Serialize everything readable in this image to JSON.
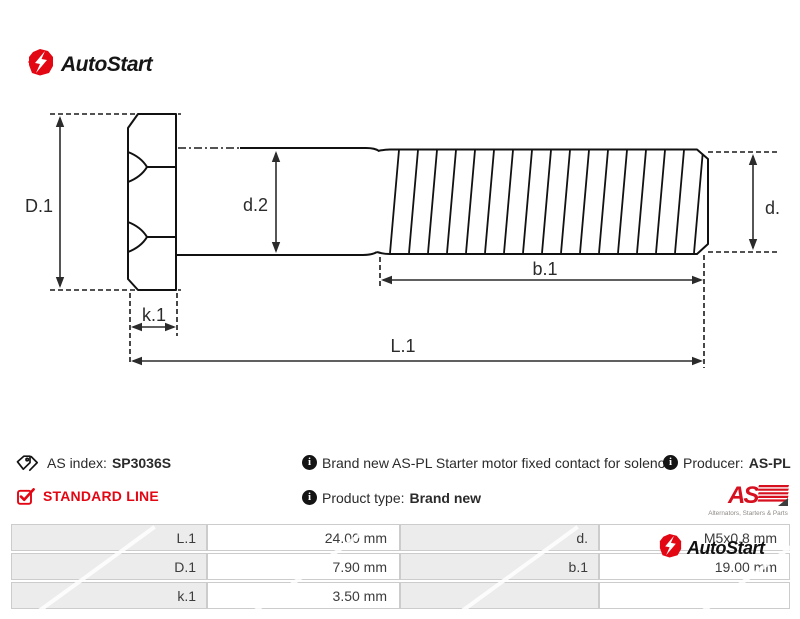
{
  "brand": {
    "name": "AutoStart",
    "accent_red": "#e30613",
    "info_glyph": "i"
  },
  "drawing": {
    "labels": {
      "D1": "D.1",
      "d2": "d.2",
      "d": "d.",
      "k1": "k.1",
      "b1": "b.1",
      "L1": "L.1"
    }
  },
  "info": {
    "as_index_label": "AS index:",
    "as_index_value": "SP3036S",
    "standard_line": "STANDARD LINE",
    "description": "Brand new AS-PL Starter motor fixed contact for solenoid",
    "product_type_label": "Product type:",
    "product_type_value": "Brand new",
    "producer_label": "Producer:",
    "producer_value": "AS-PL"
  },
  "aspl_logo": {
    "text": "AS",
    "subtext": "Alternators, Starters & Parts"
  },
  "spec_table": {
    "rows": [
      {
        "label1": "L.1",
        "value1": "24.00 mm",
        "label2": "d.",
        "value2": "M5x0.8 mm"
      },
      {
        "label1": "D.1",
        "value1": "7.90 mm",
        "label2": "b.1",
        "value2": "19.00 mm"
      },
      {
        "label1": "k.1",
        "value1": "3.50 mm",
        "label2": "",
        "value2": ""
      }
    ]
  }
}
